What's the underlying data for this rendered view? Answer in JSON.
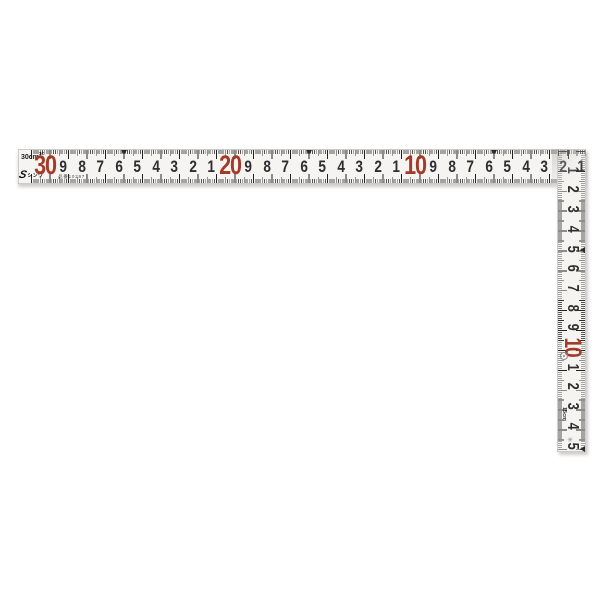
{
  "ruler": {
    "brand": {
      "mark_glyph": "S",
      "logo_text": "シンワ"
    },
    "model_number_label": "品番10297",
    "corner_label": {
      "text": "30cm",
      "sup": "1C"
    },
    "colors": {
      "red_number": "#a43b28",
      "ink": "#2e2e2e",
      "body": "#f5f4f1",
      "shadow": "#c9c8c5"
    },
    "horizontal_scale": {
      "unit": "cm",
      "length_cm": 30,
      "reads_from": "outer-corner-right-to-left",
      "triangle_marks_cm": [
        5,
        15,
        25
      ],
      "numbers": [
        {
          "cm": 30,
          "label": "30",
          "red": true
        },
        {
          "cm": 29,
          "label": "9",
          "red": false
        },
        {
          "cm": 28,
          "label": "8",
          "red": false
        },
        {
          "cm": 27,
          "label": "7",
          "red": false
        },
        {
          "cm": 26,
          "label": "6",
          "red": false
        },
        {
          "cm": 25,
          "label": "5",
          "red": false
        },
        {
          "cm": 24,
          "label": "4",
          "red": false
        },
        {
          "cm": 23,
          "label": "3",
          "red": false
        },
        {
          "cm": 22,
          "label": "2",
          "red": false
        },
        {
          "cm": 21,
          "label": "1",
          "red": false
        },
        {
          "cm": 20,
          "label": "20",
          "red": true
        },
        {
          "cm": 19,
          "label": "9",
          "red": false
        },
        {
          "cm": 18,
          "label": "8",
          "red": false
        },
        {
          "cm": 17,
          "label": "7",
          "red": false
        },
        {
          "cm": 16,
          "label": "6",
          "red": false
        },
        {
          "cm": 15,
          "label": "5",
          "red": false
        },
        {
          "cm": 14,
          "label": "4",
          "red": false
        },
        {
          "cm": 13,
          "label": "3",
          "red": false
        },
        {
          "cm": 12,
          "label": "2",
          "red": false
        },
        {
          "cm": 11,
          "label": "1",
          "red": false
        },
        {
          "cm": 10,
          "label": "10",
          "red": true
        },
        {
          "cm": 9,
          "label": "9",
          "red": false
        },
        {
          "cm": 8,
          "label": "8",
          "red": false
        },
        {
          "cm": 7,
          "label": "7",
          "red": false
        },
        {
          "cm": 6,
          "label": "6",
          "red": false
        },
        {
          "cm": 5,
          "label": "5",
          "red": false
        },
        {
          "cm": 4,
          "label": "4",
          "red": false
        },
        {
          "cm": 3,
          "label": "3",
          "red": false
        },
        {
          "cm": 2,
          "label": "2",
          "red": false
        },
        {
          "cm": 1,
          "label": "1",
          "red": false
        }
      ]
    },
    "vertical_scale": {
      "unit": "cm",
      "length_cm": 15,
      "end_label": "15cm",
      "reads_from": "outer-corner-top-to-bottom",
      "triangle_marks_cm": [
        5,
        15
      ],
      "numbers": [
        {
          "cm": 1,
          "label": "1",
          "red": false
        },
        {
          "cm": 2,
          "label": "2",
          "red": false
        },
        {
          "cm": 3,
          "label": "3",
          "red": false
        },
        {
          "cm": 4,
          "label": "4",
          "red": false
        },
        {
          "cm": 5,
          "label": "5",
          "red": false
        },
        {
          "cm": 6,
          "label": "6",
          "red": false
        },
        {
          "cm": 7,
          "label": "7",
          "red": false
        },
        {
          "cm": 8,
          "label": "8",
          "red": false
        },
        {
          "cm": 9,
          "label": "9",
          "red": false
        },
        {
          "cm": 10,
          "label": "10",
          "red": true
        },
        {
          "cm": 11,
          "label": "1",
          "red": false
        },
        {
          "cm": 12,
          "label": "2",
          "red": false
        },
        {
          "cm": 13,
          "label": "3",
          "red": false
        },
        {
          "cm": 14,
          "label": "4",
          "red": false
        },
        {
          "cm": 15,
          "label": "5",
          "red": false
        }
      ],
      "stamps": {
        "circle_stamp_icon": "jis-circle-mark",
        "micro_text": "·····",
        "bottom_stamp_glyph": "✳"
      }
    }
  }
}
